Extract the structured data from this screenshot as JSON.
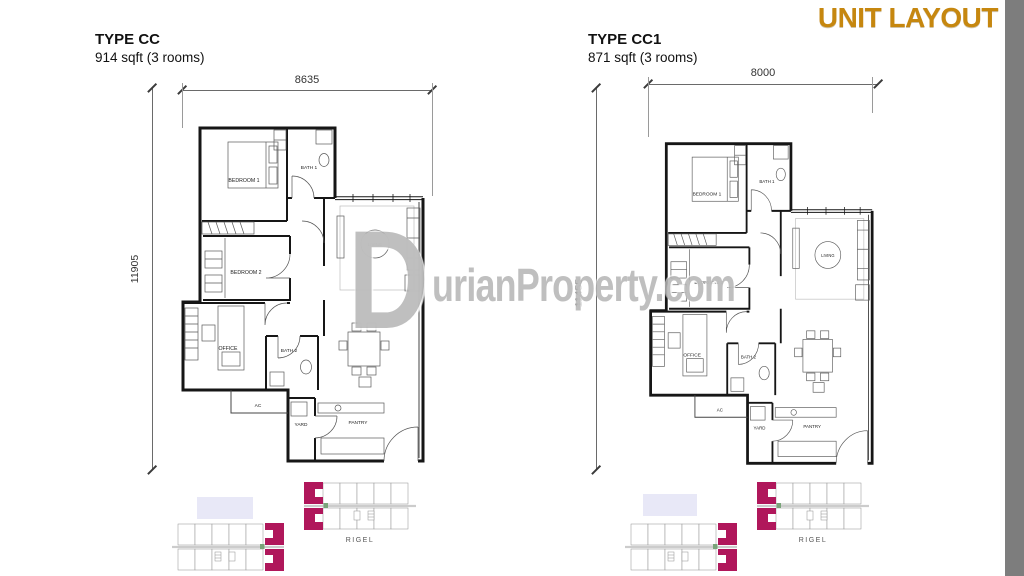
{
  "header": {
    "title": "UNIT LAYOUT"
  },
  "units": [
    {
      "type_label": "TYPE CC",
      "size_label": "914 sqft (3 rooms)",
      "width_dimension": "8635",
      "height_dimension": "11905",
      "rooms": {
        "bedroom1": "BEDROOM 1",
        "bath1": "BATH 1",
        "living": "LIVING",
        "bedroom2": "BEDROOM 2",
        "office": "OFFICE",
        "bath2": "BATH 2",
        "ac": "AC",
        "yard": "YARD",
        "pantry": "PANTRY"
      }
    },
    {
      "type_label": "TYPE CC1",
      "size_label": "871 sqft (3 rooms)",
      "width_dimension": "8000",
      "height_dimension": "11455",
      "rooms": {
        "bedroom1": "BEDROOM 1",
        "bath1": "BATH 1",
        "living": "LIVING",
        "bedroom2": "BEDROOM 2",
        "office": "OFFICE",
        "bath2": "BATH 2",
        "ac": "AC",
        "yard": "YARD",
        "pantry": "PANTRY"
      }
    }
  ],
  "watermark": {
    "initial": "D",
    "rest": "urianProperty.com"
  },
  "keyplans": [
    {
      "label": "RIGEL"
    },
    {
      "label": "RIGEL"
    }
  ],
  "colors": {
    "accent_title": "#C6870F",
    "highlight_unit": "#B0175B",
    "side_strip": "#7D7D7D",
    "keyplan_block": "#E8E8F7"
  }
}
